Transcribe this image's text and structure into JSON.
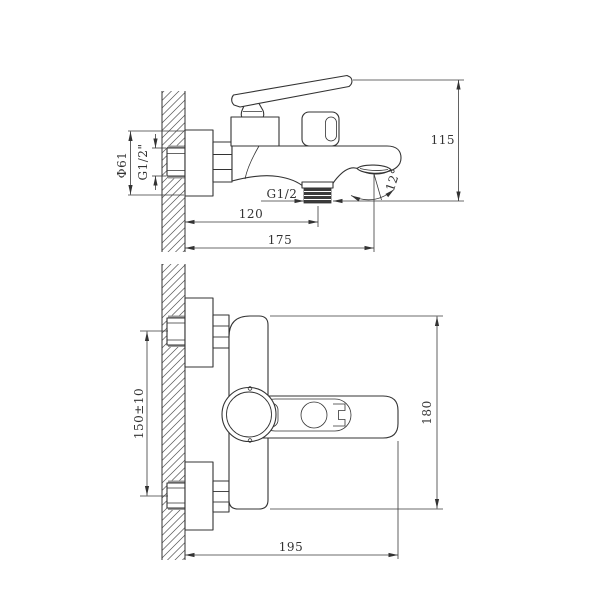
{
  "drawing": {
    "kind": "bath mixer faucet installation dimensions, two orthographic views",
    "background": "#ffffff",
    "line_color": "#333333"
  },
  "side_view": {
    "name": "side view",
    "flange_dia": "Ф61",
    "inlet_thread": "G1/2\"",
    "outlet_thread": "G1/2",
    "outlet_offset": "120",
    "spout_reach": "175",
    "height": "115",
    "spout_angle": "12°"
  },
  "front_view": {
    "name": "front view",
    "inlet_spacing": "150±10",
    "width": "195",
    "height": "180"
  }
}
